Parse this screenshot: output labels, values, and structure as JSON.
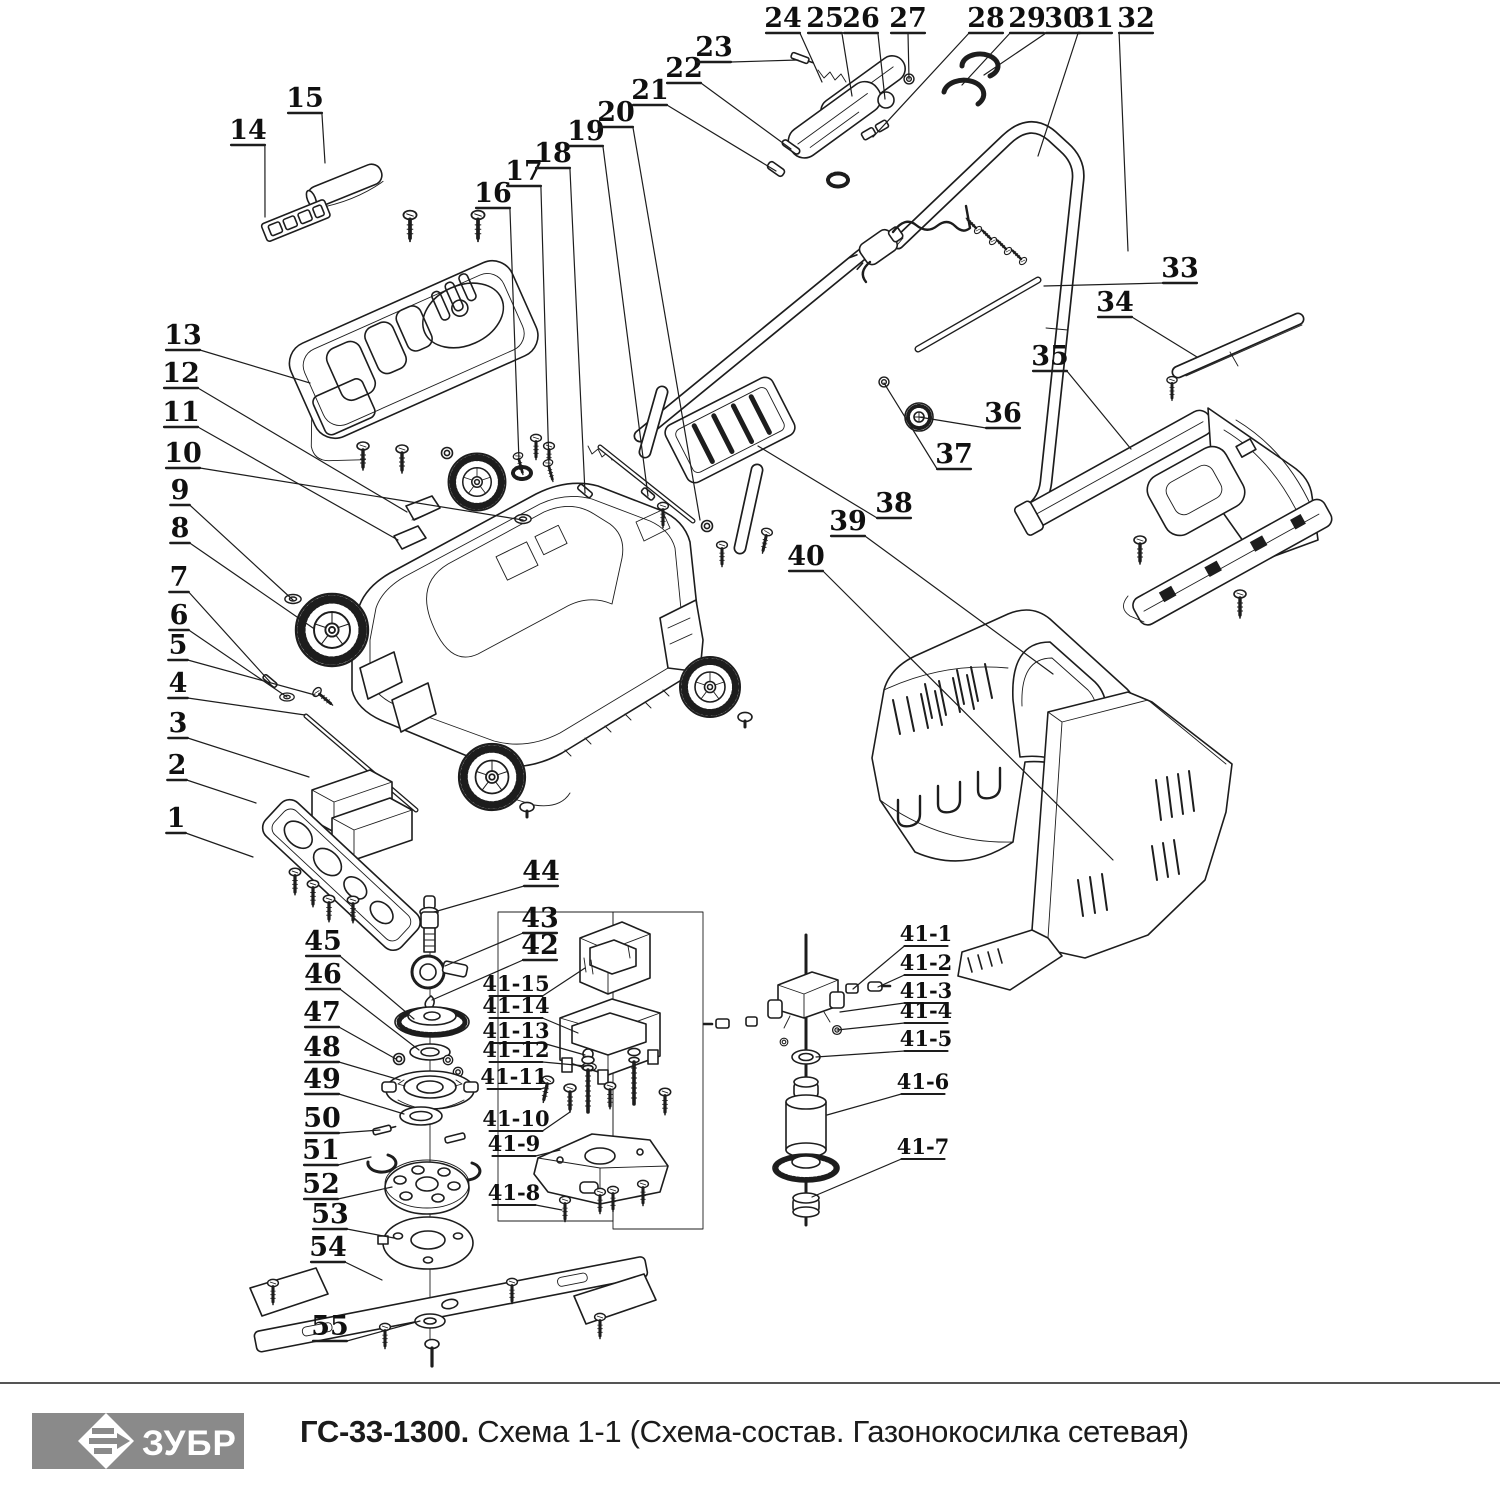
{
  "footer": {
    "brand": "ЗУБР",
    "model": "ГС-33-1300.",
    "subtitle": " Схема 1-1 (Схема-состав. Газонокосилка сетевая)"
  },
  "colors": {
    "line": "#1d1d1d",
    "logo_bg": "#8a8a8a",
    "logo_text": "#ffffff",
    "page_bg": "#ffffff"
  },
  "diagram": {
    "description": "Exploded parts diagram of an electric lawn mower with numbered callouts",
    "callouts": [
      {
        "t": "1",
        "x": 176,
        "y": 818,
        "px": 253,
        "py": 857
      },
      {
        "t": "2",
        "x": 177,
        "y": 765,
        "px": 256,
        "py": 803
      },
      {
        "t": "3",
        "x": 178,
        "y": 723,
        "px": 309,
        "py": 777
      },
      {
        "t": "4",
        "x": 178,
        "y": 683,
        "px": 305,
        "py": 715
      },
      {
        "t": "5",
        "x": 178,
        "y": 645,
        "px": 315,
        "py": 695
      },
      {
        "t": "6",
        "x": 179,
        "y": 615,
        "px": 287,
        "py": 697
      },
      {
        "t": "7",
        "x": 179,
        "y": 577,
        "px": 270,
        "py": 682
      },
      {
        "t": "8",
        "x": 180,
        "y": 528,
        "px": 313,
        "py": 628
      },
      {
        "t": "9",
        "x": 180,
        "y": 490,
        "px": 293,
        "py": 600
      },
      {
        "t": "10",
        "x": 183,
        "y": 453,
        "px": 523,
        "py": 520
      },
      {
        "t": "11",
        "x": 181,
        "y": 412,
        "px": 398,
        "py": 540
      },
      {
        "t": "12",
        "x": 181,
        "y": 373,
        "px": 407,
        "py": 512
      },
      {
        "t": "13",
        "x": 183,
        "y": 335,
        "px": 310,
        "py": 383
      },
      {
        "t": "14",
        "x": 248,
        "y": 130,
        "px": 265,
        "py": 217
      },
      {
        "t": "15",
        "x": 305,
        "y": 98,
        "px": 325,
        "py": 163
      },
      {
        "t": "16",
        "x": 493,
        "y": 193,
        "px": 519,
        "py": 461
      },
      {
        "t": "17",
        "x": 524,
        "y": 171,
        "px": 549,
        "py": 468
      },
      {
        "t": "18",
        "x": 553,
        "y": 153,
        "px": 585,
        "py": 493
      },
      {
        "t": "19",
        "x": 586,
        "y": 131,
        "px": 648,
        "py": 496
      },
      {
        "t": "20",
        "x": 616,
        "y": 112,
        "px": 700,
        "py": 520
      },
      {
        "t": "21",
        "x": 650,
        "y": 90,
        "px": 776,
        "py": 171
      },
      {
        "t": "22",
        "x": 684,
        "y": 68,
        "px": 791,
        "py": 149
      },
      {
        "t": "23",
        "x": 714,
        "y": 47,
        "px": 798,
        "py": 60
      },
      {
        "t": "24",
        "x": 783,
        "y": 18,
        "px": 822,
        "py": 82
      },
      {
        "t": "25",
        "x": 825,
        "y": 18,
        "px": 852,
        "py": 96
      },
      {
        "t": "26",
        "x": 861,
        "y": 18,
        "px": 885,
        "py": 99
      },
      {
        "t": "27",
        "x": 908,
        "y": 18,
        "px": 909,
        "py": 79
      },
      {
        "t": "28",
        "x": 986,
        "y": 18,
        "px": 873,
        "py": 137
      },
      {
        "t": "29",
        "x": 1027,
        "y": 18,
        "px": 962,
        "py": 85
      },
      {
        "t": "30",
        "x": 1063,
        "y": 18,
        "px": 984,
        "py": 75
      },
      {
        "t": "31",
        "x": 1095,
        "y": 18,
        "px": 1038,
        "py": 156
      },
      {
        "t": "32",
        "x": 1136,
        "y": 18,
        "px": 1128,
        "py": 251
      },
      {
        "t": "33",
        "x": 1180,
        "y": 268,
        "px": 1044,
        "py": 286
      },
      {
        "t": "34",
        "x": 1115,
        "y": 302,
        "px": 1197,
        "py": 357
      },
      {
        "t": "35",
        "x": 1050,
        "y": 356,
        "px": 1131,
        "py": 449
      },
      {
        "t": "36",
        "x": 1003,
        "y": 413,
        "px": 919,
        "py": 417
      },
      {
        "t": "37",
        "x": 954,
        "y": 454,
        "px": 884,
        "py": 383
      },
      {
        "t": "38",
        "x": 894,
        "y": 503,
        "px": 758,
        "py": 446
      },
      {
        "t": "39",
        "x": 848,
        "y": 521,
        "px": 1053,
        "py": 674
      },
      {
        "t": "40",
        "x": 806,
        "y": 556,
        "px": 1113,
        "py": 860
      },
      {
        "t": "44",
        "x": 541,
        "y": 871,
        "px": 434,
        "py": 912
      },
      {
        "t": "43",
        "x": 540,
        "y": 918,
        "px": 445,
        "py": 966
      },
      {
        "t": "42",
        "x": 540,
        "y": 945,
        "px": 432,
        "py": 1000
      },
      {
        "t": "45",
        "x": 323,
        "y": 941,
        "px": 414,
        "py": 1019
      },
      {
        "t": "46",
        "x": 323,
        "y": 974,
        "px": 419,
        "py": 1050
      },
      {
        "t": "47",
        "x": 322,
        "y": 1012,
        "px": 396,
        "py": 1059
      },
      {
        "t": "48",
        "x": 322,
        "y": 1047,
        "px": 400,
        "py": 1080
      },
      {
        "t": "49",
        "x": 322,
        "y": 1079,
        "px": 404,
        "py": 1114
      },
      {
        "t": "50",
        "x": 322,
        "y": 1118,
        "px": 380,
        "py": 1130
      },
      {
        "t": "51",
        "x": 321,
        "y": 1150,
        "px": 371,
        "py": 1157
      },
      {
        "t": "52",
        "x": 321,
        "y": 1184,
        "px": 392,
        "py": 1187
      },
      {
        "t": "53",
        "x": 330,
        "y": 1214,
        "px": 394,
        "py": 1238
      },
      {
        "t": "54",
        "x": 328,
        "y": 1247,
        "px": 382,
        "py": 1280
      },
      {
        "t": "55",
        "x": 330,
        "y": 1326,
        "px": 420,
        "py": 1321
      },
      {
        "t": "41-15",
        "x": 516,
        "y": 984,
        "px": 585,
        "py": 968,
        "s": 1
      },
      {
        "t": "41-14",
        "x": 516,
        "y": 1006,
        "px": 578,
        "py": 1033,
        "s": 1
      },
      {
        "t": "41-13",
        "x": 516,
        "y": 1031,
        "px": 585,
        "py": 1055,
        "s": 1
      },
      {
        "t": "41-12",
        "x": 516,
        "y": 1050,
        "px": 586,
        "py": 1066,
        "s": 1
      },
      {
        "t": "41-11",
        "x": 514,
        "y": 1077,
        "px": 548,
        "py": 1087,
        "s": 1
      },
      {
        "t": "41-10",
        "x": 516,
        "y": 1119,
        "px": 570,
        "py": 1112,
        "s": 1
      },
      {
        "t": "41-9",
        "x": 514,
        "y": 1144,
        "px": 560,
        "py": 1150,
        "s": 1
      },
      {
        "t": "41-8",
        "x": 514,
        "y": 1193,
        "px": 562,
        "py": 1210,
        "s": 1
      },
      {
        "t": "41-1",
        "x": 926,
        "y": 934,
        "px": 853,
        "py": 989,
        "s": 1
      },
      {
        "t": "41-2",
        "x": 926,
        "y": 963,
        "px": 878,
        "py": 987,
        "s": 1
      },
      {
        "t": "41-3",
        "x": 926,
        "y": 991,
        "px": 840,
        "py": 1012,
        "s": 1
      },
      {
        "t": "41-4",
        "x": 926,
        "y": 1011,
        "px": 837,
        "py": 1030,
        "s": 1
      },
      {
        "t": "41-5",
        "x": 926,
        "y": 1039,
        "px": 816,
        "py": 1057,
        "s": 1
      },
      {
        "t": "41-6",
        "x": 923,
        "y": 1082,
        "px": 827,
        "py": 1115,
        "s": 1
      },
      {
        "t": "41-7",
        "x": 923,
        "y": 1147,
        "px": 812,
        "py": 1197,
        "s": 1
      }
    ]
  }
}
